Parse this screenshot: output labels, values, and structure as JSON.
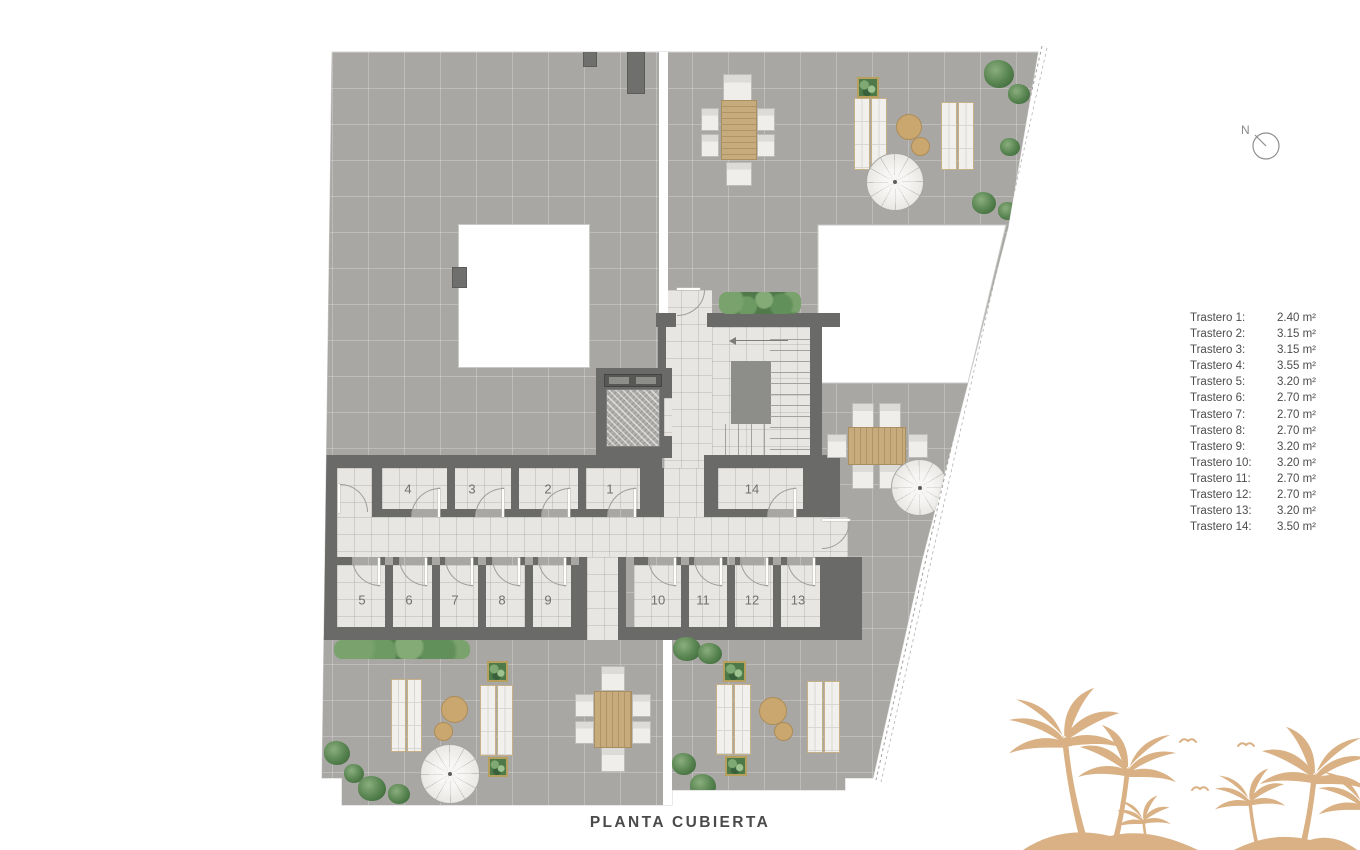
{
  "title": "PLANTA CUBIERTA",
  "north": {
    "label": "N"
  },
  "legend": {
    "items": [
      {
        "label": "Trastero 1:",
        "value": "2.40 m²"
      },
      {
        "label": "Trastero 2:",
        "value": "3.15 m²"
      },
      {
        "label": "Trastero 3:",
        "value": "3.15 m²"
      },
      {
        "label": "Trastero 4:",
        "value": "3.55 m²"
      },
      {
        "label": "Trastero 5:",
        "value": "3.20 m²"
      },
      {
        "label": "Trastero 6:",
        "value": "2.70 m²"
      },
      {
        "label": "Trastero 7:",
        "value": "2.70 m²"
      },
      {
        "label": "Trastero 8:",
        "value": "2.70 m²"
      },
      {
        "label": "Trastero 9:",
        "value": "3.20 m²"
      },
      {
        "label": "Trastero 10:",
        "value": "3.20 m²"
      },
      {
        "label": "Trastero 11:",
        "value": "2.70 m²"
      },
      {
        "label": "Trastero 12:",
        "value": "2.70 m²"
      },
      {
        "label": "Trastero 13:",
        "value": "3.20 m²"
      },
      {
        "label": "Trastero 14:",
        "value": "3.50 m²"
      }
    ]
  },
  "plan": {
    "rooms": [
      {
        "number": "1"
      },
      {
        "number": "2"
      },
      {
        "number": "3"
      },
      {
        "number": "4"
      },
      {
        "number": "5"
      },
      {
        "number": "6"
      },
      {
        "number": "7"
      },
      {
        "number": "8"
      },
      {
        "number": "9"
      },
      {
        "number": "10"
      },
      {
        "number": "11"
      },
      {
        "number": "12"
      },
      {
        "number": "13"
      },
      {
        "number": "14"
      }
    ]
  },
  "colors": {
    "wall": "#6a6a68",
    "roof_tile": "#a9a7a4",
    "interior_floor": "#e7e6e3",
    "wood": "#c6ab7d",
    "greenery": "#55824e",
    "palm": "#d9b185",
    "text": "#4c4c4c"
  }
}
